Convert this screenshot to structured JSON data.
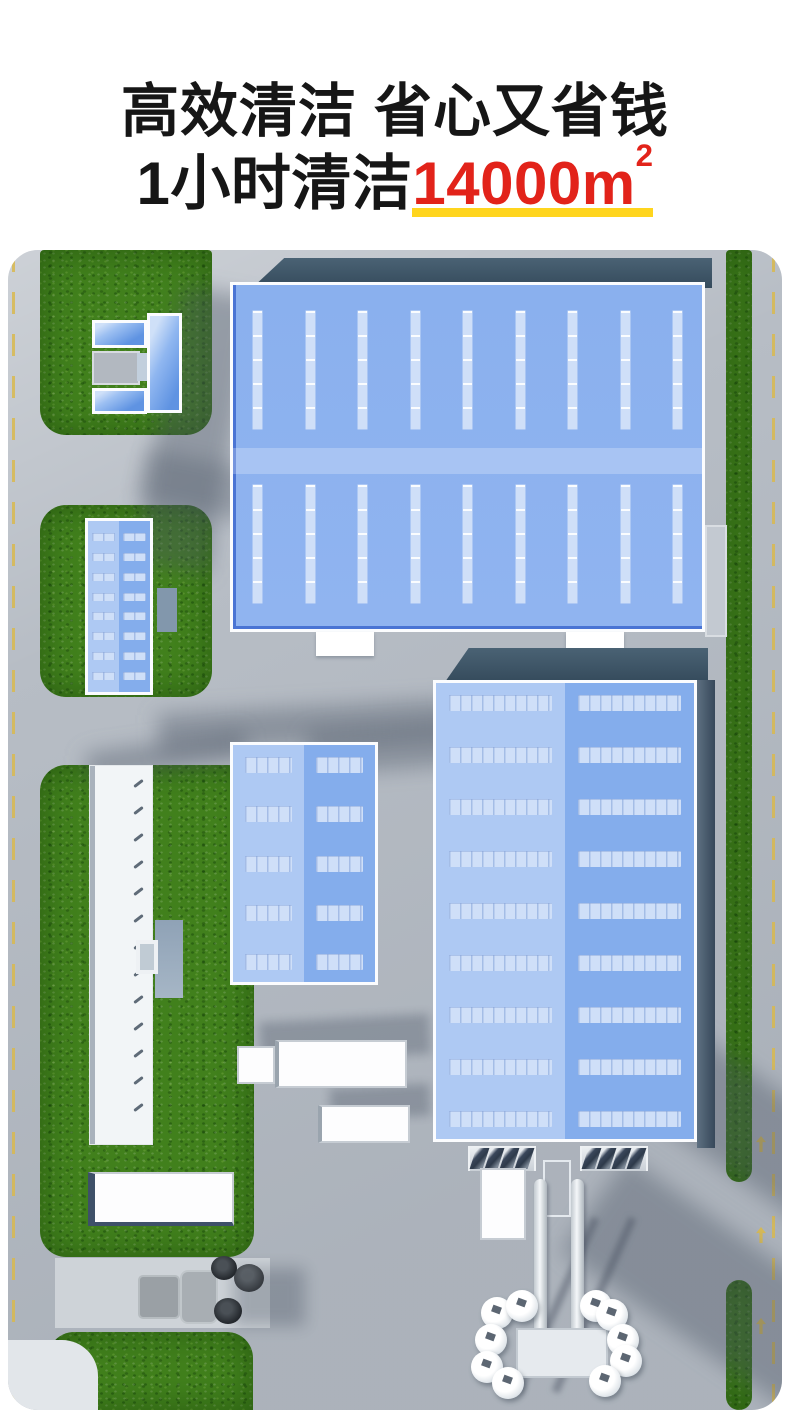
{
  "header": {
    "line1": "高效清洁 省心又省钱",
    "line2_prefix": "1小时清洁",
    "line2_value": "14000m",
    "line2_sup": "2"
  },
  "theme": {
    "ink": "#161616",
    "red": "#e2231a",
    "yellow": "#ffd51e",
    "pave": "#b7bdc5",
    "pave_light": "#ced3d8",
    "grass": "#41801c",
    "roof": "#88aeed",
    "roof_light": "#aec9f3",
    "roof_mid": "#84adec",
    "strip": "#cfdff8",
    "wall": "#415a6c",
    "road_mark": "#d9b94e",
    "shadow": "#46525f"
  },
  "scene": {
    "label": "aerial-3d-industrial-park",
    "patterns": {
      "warehouse_skylight_columns": 9,
      "small_building_rows": 8,
      "center_building_rows": 5,
      "right_building_rows": 9,
      "white_building_ticks": 13,
      "dock_fins_per_group": 4,
      "brushes_per_side": 5,
      "road_arrows": 3
    },
    "elements": [
      "left-road",
      "right-road",
      "u-shaped-building",
      "large-warehouse",
      "small-blue-building",
      "long-white-building",
      "center-blue-building",
      "right-blue-building",
      "box-truck",
      "container-truck",
      "cargo-container",
      "road-sweeper",
      "gantry-cleaning-machine"
    ]
  }
}
